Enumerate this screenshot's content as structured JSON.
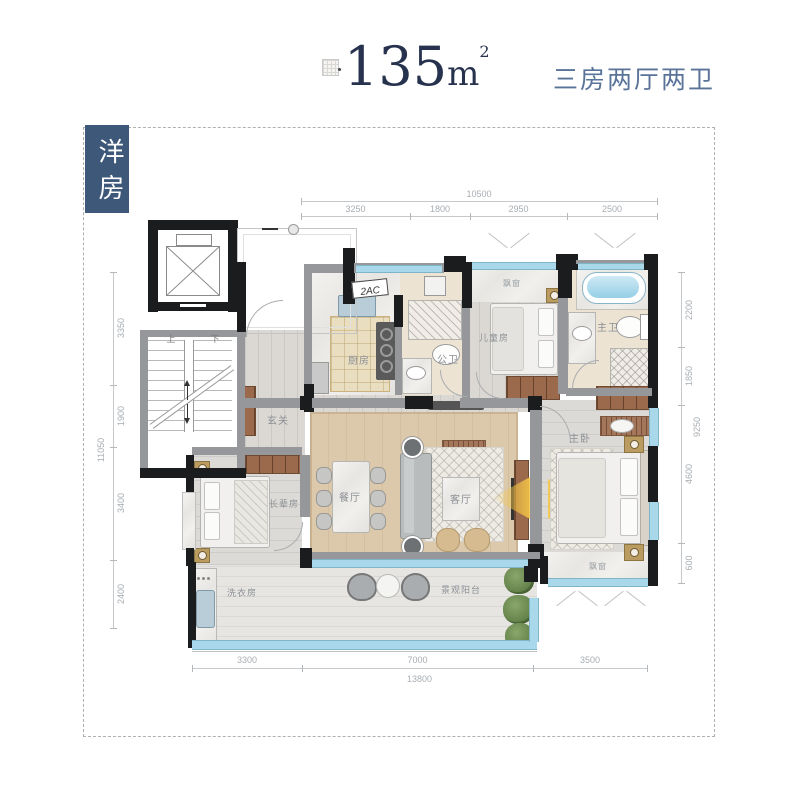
{
  "header": {
    "area_value": "135",
    "area_unit": "m",
    "area_sup": "2",
    "subtitle": "三房两厅两卫",
    "tag": "洋房"
  },
  "rooms": {
    "kitchen": "厨房",
    "guest_bath": "公卫",
    "children_room": "儿童房",
    "master_bath": "主卫",
    "foyer": "玄关",
    "dining": "餐厅",
    "living": "客厅",
    "master_bedroom": "主卧",
    "elders_room": "长辈房",
    "laundry": "洗衣房",
    "balcony": "景观阳台",
    "bay_window_top": "飘窗",
    "bay_window_bottom": "飘窗"
  },
  "annotations": {
    "ac": "2AC",
    "stairs_up": "上",
    "stairs_down": "下"
  },
  "dimensions": {
    "top": {
      "total": "10500",
      "segments": [
        "3250",
        "1800",
        "2950",
        "2500"
      ]
    },
    "left": {
      "total": "11050",
      "segments": [
        "3350",
        "1900",
        "3400",
        "2400"
      ]
    },
    "right": {
      "total": "9250",
      "segments": [
        "2200",
        "1850",
        "4600",
        "600"
      ]
    },
    "bottom": {
      "total": "13800",
      "segments": [
        "3300",
        "7000",
        "3500"
      ]
    }
  },
  "colors": {
    "title_navy": "#27324e",
    "subtitle_blue": "#5a7398",
    "tag_background": "#3d5878",
    "window_blue": "#a9d8ea",
    "wood_floor": "#dcc9ac",
    "cabinet_brown": "#9b6a4c",
    "light_beam_yellow": "#f6c646"
  }
}
